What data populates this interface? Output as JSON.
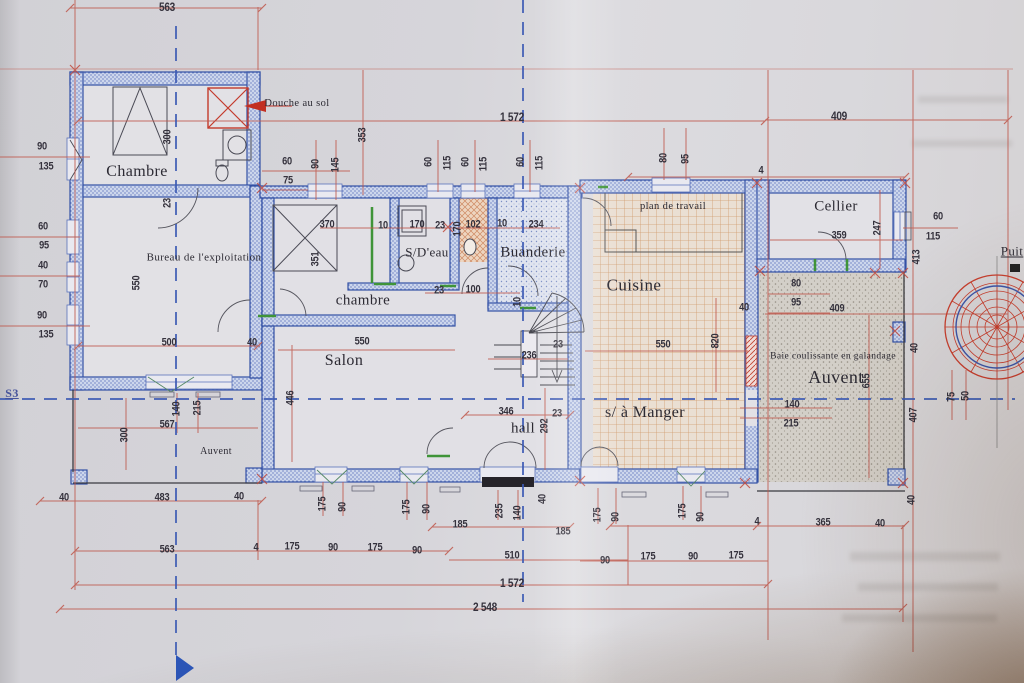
{
  "document": {
    "type": "photographed architectural floor plan (ground floor)",
    "section_axis": "S3",
    "colors": {
      "paper": "#d7d6db",
      "wall_blue": "#3351a5",
      "dimension_red": "#bf584c",
      "axis_blue": "#3c5ab4",
      "accent_green": "#3f9438",
      "well_red": "#c63f2e",
      "shadow_brown": "#8f7052"
    }
  },
  "labels": {
    "rooms": [
      {
        "t": "Chambre",
        "x": 137,
        "y": 172,
        "s": 16
      },
      {
        "t": "Bureau de l'exploitation",
        "x": 204,
        "y": 258,
        "s": 11
      },
      {
        "t": "chambre",
        "x": 363,
        "y": 301,
        "s": 15
      },
      {
        "t": "S/D'eau",
        "x": 427,
        "y": 252,
        "s": 13
      },
      {
        "t": "Buanderie",
        "x": 533,
        "y": 253,
        "s": 15
      },
      {
        "t": "Salon",
        "x": 344,
        "y": 361,
        "s": 16
      },
      {
        "t": "hall",
        "x": 523,
        "y": 429,
        "s": 15
      },
      {
        "t": "Cuisine",
        "x": 634,
        "y": 285,
        "s": 17
      },
      {
        "t": "Cellier",
        "x": 836,
        "y": 207,
        "s": 15
      },
      {
        "t": "s/ à Manger",
        "x": 645,
        "y": 413,
        "s": 16
      },
      {
        "t": "Auvent",
        "x": 836,
        "y": 377,
        "s": 18
      },
      {
        "t": "Auvent",
        "x": 216,
        "y": 452,
        "s": 10
      }
    ],
    "annotations": [
      {
        "t": "Douche au sol",
        "x": 297,
        "y": 104,
        "s": 10.5
      },
      {
        "t": "plan de travail",
        "x": 673,
        "y": 207,
        "s": 10.5
      },
      {
        "t": "Baie coulissante en galandage",
        "x": 833,
        "y": 357,
        "s": 9.5
      },
      {
        "t": "Puit",
        "x": 1012,
        "y": 251,
        "s": 13,
        "u": 1
      },
      {
        "t": "S3",
        "x": 12,
        "y": 393,
        "s": 12,
        "u": 1,
        "c": 1
      }
    ],
    "dimensions": [
      {
        "t": "563",
        "x": 167,
        "y": 7,
        "s": 12
      },
      {
        "t": "1 572",
        "x": 512,
        "y": 117,
        "s": 12
      },
      {
        "t": "409",
        "x": 839,
        "y": 116,
        "s": 12
      },
      {
        "t": "353",
        "x": 363,
        "y": 135,
        "v": 1
      },
      {
        "t": "60",
        "x": 287,
        "y": 162
      },
      {
        "t": "75",
        "x": 288,
        "y": 181
      },
      {
        "t": "90",
        "x": 316,
        "y": 164,
        "v": 1
      },
      {
        "t": "145",
        "x": 336,
        "y": 165,
        "v": 1
      },
      {
        "t": "60",
        "x": 429,
        "y": 162,
        "v": 1
      },
      {
        "t": "115",
        "x": 448,
        "y": 163,
        "v": 1
      },
      {
        "t": "60",
        "x": 466,
        "y": 162,
        "v": 1
      },
      {
        "t": "115",
        "x": 484,
        "y": 164,
        "v": 1
      },
      {
        "t": "60",
        "x": 521,
        "y": 162,
        "v": 1
      },
      {
        "t": "115",
        "x": 540,
        "y": 163,
        "v": 1
      },
      {
        "t": "80",
        "x": 664,
        "y": 158,
        "v": 1
      },
      {
        "t": "95",
        "x": 686,
        "y": 159,
        "v": 1
      },
      {
        "t": "4",
        "x": 761,
        "y": 171
      },
      {
        "t": "90",
        "x": 42,
        "y": 147
      },
      {
        "t": "135",
        "x": 46,
        "y": 167
      },
      {
        "t": "300",
        "x": 168,
        "y": 137,
        "v": 1
      },
      {
        "t": "23",
        "x": 168,
        "y": 203,
        "v": 1
      },
      {
        "t": "60",
        "x": 43,
        "y": 227
      },
      {
        "t": "95",
        "x": 44,
        "y": 246
      },
      {
        "t": "40",
        "x": 43,
        "y": 266
      },
      {
        "t": "70",
        "x": 43,
        "y": 285
      },
      {
        "t": "90",
        "x": 42,
        "y": 316
      },
      {
        "t": "135",
        "x": 46,
        "y": 335
      },
      {
        "t": "550",
        "x": 137,
        "y": 283,
        "v": 1
      },
      {
        "t": "370",
        "x": 327,
        "y": 225
      },
      {
        "t": "10",
        "x": 383,
        "y": 226
      },
      {
        "t": "170",
        "x": 417,
        "y": 225
      },
      {
        "t": "23",
        "x": 440,
        "y": 226
      },
      {
        "t": "170",
        "x": 458,
        "y": 229,
        "v": 1
      },
      {
        "t": "102",
        "x": 473,
        "y": 225
      },
      {
        "t": "10",
        "x": 502,
        "y": 224
      },
      {
        "t": "234",
        "x": 536,
        "y": 225
      },
      {
        "t": "351",
        "x": 316,
        "y": 259,
        "v": 1
      },
      {
        "t": "359",
        "x": 839,
        "y": 236
      },
      {
        "t": "247",
        "x": 878,
        "y": 228,
        "v": 1
      },
      {
        "t": "60",
        "x": 938,
        "y": 217
      },
      {
        "t": "115",
        "x": 933,
        "y": 237
      },
      {
        "t": "413",
        "x": 917,
        "y": 257,
        "v": 1
      },
      {
        "t": "23",
        "x": 439,
        "y": 291
      },
      {
        "t": "100",
        "x": 473,
        "y": 290
      },
      {
        "t": "10",
        "x": 518,
        "y": 302,
        "v": 1
      },
      {
        "t": "500",
        "x": 169,
        "y": 343
      },
      {
        "t": "40",
        "x": 252,
        "y": 343
      },
      {
        "t": "550",
        "x": 362,
        "y": 342
      },
      {
        "t": "236",
        "x": 529,
        "y": 356
      },
      {
        "t": "23",
        "x": 558,
        "y": 345
      },
      {
        "t": "550",
        "x": 663,
        "y": 345
      },
      {
        "t": "820",
        "x": 716,
        "y": 341,
        "v": 1
      },
      {
        "t": "40",
        "x": 744,
        "y": 308
      },
      {
        "t": "80",
        "x": 796,
        "y": 284
      },
      {
        "t": "95",
        "x": 796,
        "y": 303
      },
      {
        "t": "409",
        "x": 837,
        "y": 309
      },
      {
        "t": "446",
        "x": 291,
        "y": 398,
        "v": 1
      },
      {
        "t": "140",
        "x": 177,
        "y": 409,
        "v": 1
      },
      {
        "t": "215",
        "x": 198,
        "y": 408,
        "v": 1
      },
      {
        "t": "567",
        "x": 167,
        "y": 425
      },
      {
        "t": "300",
        "x": 125,
        "y": 435,
        "v": 1
      },
      {
        "t": "346",
        "x": 506,
        "y": 412
      },
      {
        "t": "23",
        "x": 557,
        "y": 414
      },
      {
        "t": "292",
        "x": 545,
        "y": 426,
        "v": 1
      },
      {
        "t": "140",
        "x": 792,
        "y": 405
      },
      {
        "t": "215",
        "x": 791,
        "y": 424
      },
      {
        "t": "655",
        "x": 867,
        "y": 381,
        "v": 1
      },
      {
        "t": "40",
        "x": 915,
        "y": 348,
        "v": 1
      },
      {
        "t": "407",
        "x": 914,
        "y": 415,
        "v": 1
      },
      {
        "t": "75",
        "x": 952,
        "y": 397,
        "v": 1
      },
      {
        "t": "50",
        "x": 966,
        "y": 396,
        "v": 1
      },
      {
        "t": "40",
        "x": 64,
        "y": 498
      },
      {
        "t": "483",
        "x": 162,
        "y": 498
      },
      {
        "t": "40",
        "x": 239,
        "y": 497
      },
      {
        "t": "175",
        "x": 323,
        "y": 504,
        "v": 1
      },
      {
        "t": "90",
        "x": 343,
        "y": 507,
        "v": 1
      },
      {
        "t": "175",
        "x": 407,
        "y": 507,
        "v": 1
      },
      {
        "t": "90",
        "x": 427,
        "y": 509,
        "v": 1
      },
      {
        "t": "185",
        "x": 460,
        "y": 525
      },
      {
        "t": "235",
        "x": 500,
        "y": 511,
        "v": 1
      },
      {
        "t": "140",
        "x": 518,
        "y": 513,
        "v": 1
      },
      {
        "t": "40",
        "x": 543,
        "y": 499,
        "v": 1
      },
      {
        "t": "185",
        "x": 563,
        "y": 532
      },
      {
        "t": "175",
        "x": 598,
        "y": 515,
        "v": 1
      },
      {
        "t": "90",
        "x": 616,
        "y": 517,
        "v": 1
      },
      {
        "t": "175",
        "x": 683,
        "y": 511,
        "v": 1
      },
      {
        "t": "90",
        "x": 701,
        "y": 517,
        "v": 1
      },
      {
        "t": "4",
        "x": 757,
        "y": 522
      },
      {
        "t": "365",
        "x": 823,
        "y": 523
      },
      {
        "t": "40",
        "x": 880,
        "y": 524
      },
      {
        "t": "40",
        "x": 912,
        "y": 500,
        "v": 1
      },
      {
        "t": "563",
        "x": 167,
        "y": 550
      },
      {
        "t": "4",
        "x": 256,
        "y": 548
      },
      {
        "t": "175",
        "x": 292,
        "y": 547
      },
      {
        "t": "90",
        "x": 333,
        "y": 548
      },
      {
        "t": "175",
        "x": 375,
        "y": 548
      },
      {
        "t": "90",
        "x": 417,
        "y": 551
      },
      {
        "t": "510",
        "x": 512,
        "y": 556
      },
      {
        "t": "90",
        "x": 605,
        "y": 561
      },
      {
        "t": "175",
        "x": 648,
        "y": 557
      },
      {
        "t": "90",
        "x": 693,
        "y": 557
      },
      {
        "t": "175",
        "x": 736,
        "y": 556
      },
      {
        "t": "1 572",
        "x": 512,
        "y": 583,
        "s": 12
      },
      {
        "t": "2 548",
        "x": 485,
        "y": 607,
        "s": 12
      }
    ]
  }
}
